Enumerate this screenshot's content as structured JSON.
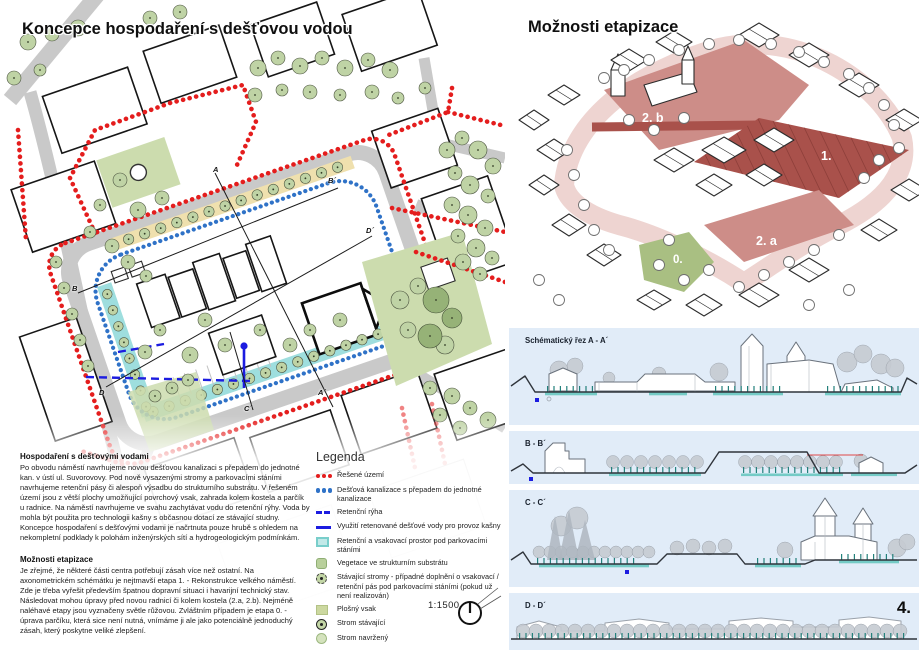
{
  "page": {
    "number": "4."
  },
  "map": {
    "title": "Koncepce hospodaření s dešťovou vodou",
    "scale_label": "1:1500",
    "markers": [
      "A",
      "A´",
      "B",
      "B´",
      "C´",
      "D",
      "D´"
    ]
  },
  "axon": {
    "title": "Možnosti etapizace",
    "stage_labels": [
      "2. b",
      "1.",
      "2. a",
      "0."
    ]
  },
  "sections": {
    "items": [
      {
        "label": "Schématický řez A - A´"
      },
      {
        "label": "B - B´"
      },
      {
        "label": "C - C´"
      },
      {
        "label": "D - D´"
      }
    ]
  },
  "texts": {
    "block1": {
      "heading": "Hospodaření s dešťovými vodami",
      "body": "Po obvodu náměstí navrhujeme novou dešťovou kanalizaci s přepadem do jednotné kan. v ústí ul. Suvorovovy. Pod nově vysazenými stromy a parkovacími stáními navrhujeme retenční pásy či alespoň výsadbu do strukturního substrátu. V řešeném území jsou z větší plochy umožňující povrchový vsak, zahrada kolem kostela a parčík u radnice. Na náměstí navrhujeme ve svahu zachytávat vodu do retenční rýhy. Voda by mohla být použita pro technologii kašny s občasnou dotací ze stávající studny. Koncepce hospodaření s dešťovými vodami je načrtnuta pouze hrubě s ohledem na nekompletní podklady k polohám inženýrských sítí a hydrogeologickým podmínkám."
    },
    "block2": {
      "heading": "Možnosti etapizace",
      "body": "Je zřejmé, že některé části centra potřebují zásah více než ostatní. Na axonometrickém schémátku je nejtmavší etapa 1. - Rekonstrukce velkého náměstí. Zde je třeba vyřešit především špatnou dopravní situaci i havarijní technický stav. Následovat mohou úpravy před novou radnicí či kolem kostela (2.a, 2.b). Nejméně naléhavé etapy jsou vyznačeny světle růžovou. Zvláštním případem je etapa 0. - úprava parčíku, která sice není nutná, vnímáme ji ale jako potenciálně jednoduchý zásah, který poskytne veliké zlepšení."
    }
  },
  "legend": {
    "title": "Legenda",
    "items": [
      {
        "marker": "red-dots",
        "label": "Řešené území"
      },
      {
        "marker": "blue-dots",
        "label": "Dešťová kanalizace s přepadem do jednotné kanalizace"
      },
      {
        "marker": "blue-dash",
        "label": "Retenční rýha"
      },
      {
        "marker": "blue-line",
        "label": "Využití retenované dešťové vody pro provoz kašny"
      },
      {
        "marker": "cyan-square",
        "label": "Retenční a vsakovací prostor pod parkovacími stáními"
      },
      {
        "marker": "veg-square",
        "label": "Vegetace ve strukturním substrátu"
      },
      {
        "marker": "tree-note",
        "label": "Stávající stromy - případné doplnění o vsakovací / retenční pás pod parkovacími stáními (pokud už není realizován)"
      },
      {
        "marker": "green-square",
        "label": "Plošný vsak"
      },
      {
        "marker": "tree-existing",
        "label": "Strom stávající"
      },
      {
        "marker": "tree-proposed",
        "label": "Strom navržený"
      }
    ]
  },
  "colors": {
    "boundary_red": "#e41d1d",
    "sewer_blue": "#2f72c7",
    "trench_blue": "#1c1ce0",
    "retention_cyan": "#9edede",
    "substrate_tan": "#efe0ae",
    "stage_dark": "#a9514b",
    "stage_mid": "#cd8d88",
    "stage_light": "#eed4d1",
    "stage_green": "#a9bf82",
    "section_bg": "#e1ecf8"
  }
}
